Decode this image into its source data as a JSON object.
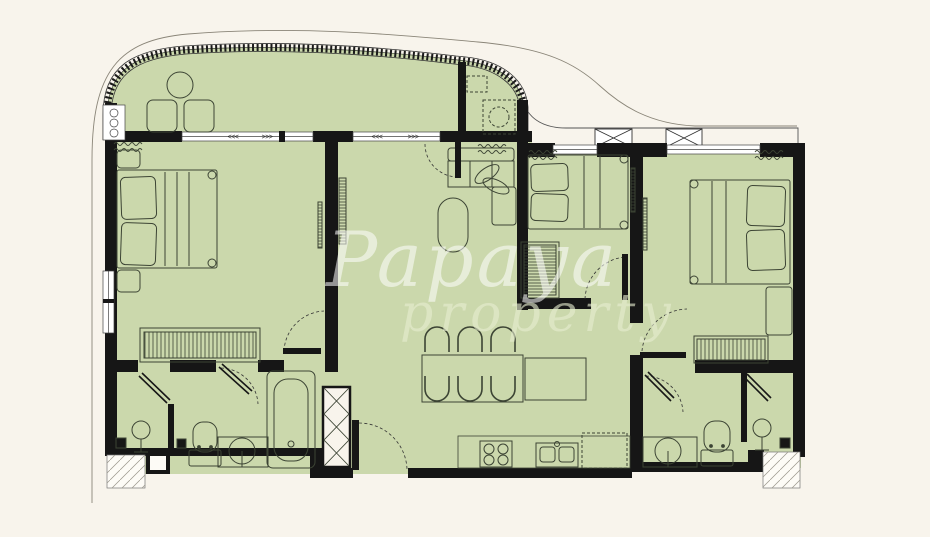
{
  "watermark": {
    "line1": "Papaya",
    "line2": "property"
  },
  "markers": {
    "slide_left": "<<<",
    "slide_right": ">>>"
  },
  "colors": {
    "background": "#f8f4ec",
    "floor": "#cbd8ac",
    "wall": "#161616",
    "furniture_line": "#3c4434",
    "outer_contour": "#8a8578",
    "glass": "#ffffff",
    "watermark_primary": "rgba(255,255,255,0.55)",
    "watermark_secondary": "rgba(231,238,208,0.62)"
  },
  "plan": {
    "type": "apartment-floor-plan",
    "rooms": [
      {
        "id": "balcony",
        "furniture": [
          "round-table",
          "chair",
          "chair",
          "dashed-utility-unit",
          "railing"
        ]
      },
      {
        "id": "bedroom-left",
        "furniture": [
          "double-bed",
          "pillow",
          "pillow",
          "nightstand",
          "nightstand",
          "wardrobe",
          "ac-unit",
          "tv"
        ]
      },
      {
        "id": "living-room",
        "furniture": [
          "sofa",
          "plant",
          "coffee-table",
          "tv",
          "ac-unit",
          "balcony-door"
        ]
      },
      {
        "id": "dining-area",
        "furniture": [
          "dining-table",
          "chair",
          "chair",
          "chair",
          "chair",
          "chair",
          "chair",
          "island-counter"
        ]
      },
      {
        "id": "kitchen",
        "furniture": [
          "counter",
          "hob-4-burner",
          "double-sink",
          "refrigerator-dashed"
        ]
      },
      {
        "id": "bathroom-left",
        "furniture": [
          "shower",
          "glass-door",
          "toilet",
          "washbasin",
          "bathtub",
          "floor-drain",
          "floor-drain"
        ]
      },
      {
        "id": "bedroom-middle",
        "furniture": [
          "double-bed",
          "pillow",
          "pillow",
          "wardrobe",
          "ac-unit",
          "tv"
        ]
      },
      {
        "id": "bedroom-right",
        "furniture": [
          "double-bed",
          "pillow",
          "pillow",
          "nightstand",
          "wardrobe",
          "ac-unit",
          "tv"
        ]
      },
      {
        "id": "bathroom-right",
        "furniture": [
          "shower",
          "glass-door",
          "toilet",
          "washbasin",
          "floor-drain"
        ]
      },
      {
        "id": "exterior",
        "furniture": [
          "ac-condenser",
          "ac-condenser",
          "ac-ledge",
          "entry-recess",
          "entry-recess",
          "service-shaft",
          "entrance-door"
        ]
      }
    ]
  }
}
